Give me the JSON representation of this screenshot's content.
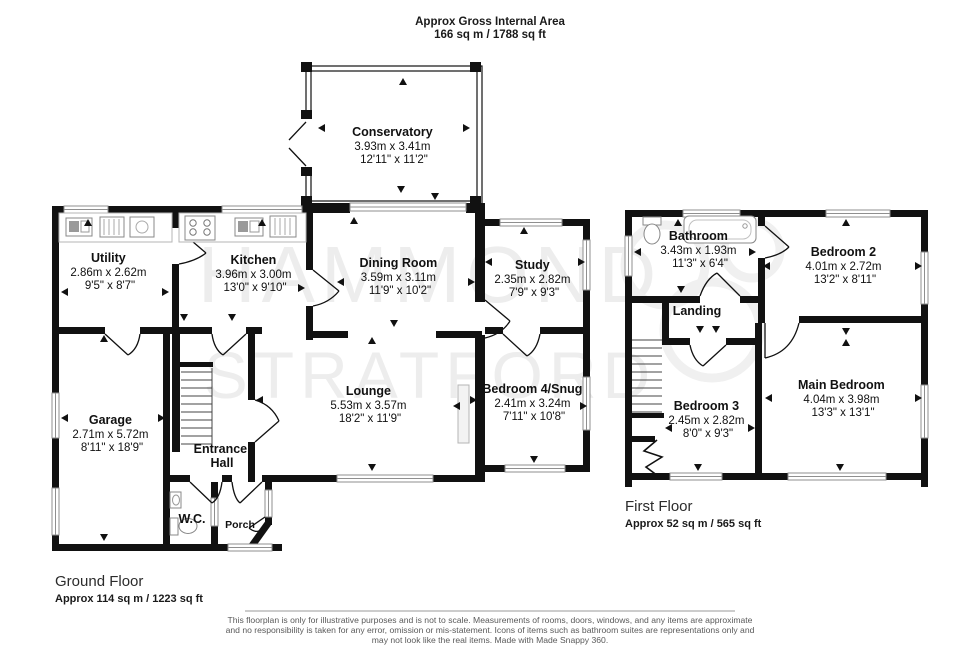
{
  "header": {
    "title": "Approx Gross Internal Area",
    "area": "166 sq m / 1788 sq ft"
  },
  "watermark": {
    "line1": "HAMMOND",
    "line2": "STRATFORD"
  },
  "ground_floor": {
    "label": "Ground Floor",
    "area": "Approx 114 sq m / 1223 sq ft",
    "rooms": {
      "conservatory": {
        "name": "Conservatory",
        "metric": "3.93m x 3.41m",
        "imperial": "12'11\" x 11'2\""
      },
      "utility": {
        "name": "Utility",
        "metric": "2.86m x 2.62m",
        "imperial": "9'5\" x 8'7\""
      },
      "kitchen": {
        "name": "Kitchen",
        "metric": "3.96m x 3.00m",
        "imperial": "13'0\" x 9'10\""
      },
      "dining": {
        "name": "Dining Room",
        "metric": "3.59m x 3.11m",
        "imperial": "11'9\" x 10'2\""
      },
      "study": {
        "name": "Study",
        "metric": "2.35m x 2.82m",
        "imperial": "7'9\" x 9'3\""
      },
      "lounge": {
        "name": "Lounge",
        "metric": "5.53m x 3.57m",
        "imperial": "18'2\" x 11'9\""
      },
      "snug": {
        "name": "Bedroom 4/Snug",
        "metric": "2.41m x 3.24m",
        "imperial": "7'11\" x 10'8\""
      },
      "garage": {
        "name": "Garage",
        "metric": "2.71m x 5.72m",
        "imperial": "8'11\" x 18'9\""
      },
      "hall": {
        "name_line1": "Entrance",
        "name_line2": "Hall"
      },
      "wc": {
        "name": "W.C."
      },
      "porch": {
        "name": "Porch"
      }
    }
  },
  "first_floor": {
    "label": "First Floor",
    "area": "Approx 52 sq m / 565 sq ft",
    "rooms": {
      "bathroom": {
        "name": "Bathroom",
        "metric": "3.43m x 1.93m",
        "imperial": "11'3\" x 6'4\""
      },
      "bedroom2": {
        "name": "Bedroom 2",
        "metric": "4.01m x 2.72m",
        "imperial": "13'2\" x 8'11\""
      },
      "landing": {
        "name": "Landing"
      },
      "bedroom3": {
        "name": "Bedroom 3",
        "metric": "2.45m x 2.82m",
        "imperial": "8'0\" x 9'3\""
      },
      "main_bedroom": {
        "name": "Main Bedroom",
        "metric": "4.04m x 3.98m",
        "imperial": "13'3\" x 13'1\""
      }
    }
  },
  "footer": {
    "line1": "This floorplan is only for illustrative purposes and is not to scale. Measurements of rooms, doors, windows, and any items are approximate",
    "line2": "and no responsibility is taken for any error, omission or mis-statement. Icons of items such as bathroom suites are representations only and",
    "line3": "may not look like the real items. Made with Made Snappy 360."
  },
  "colors": {
    "wall": "#111111",
    "window_stroke": "#8f8f8f",
    "watermark": "#ededed",
    "disclaimer_text": "#5a5a5a"
  }
}
